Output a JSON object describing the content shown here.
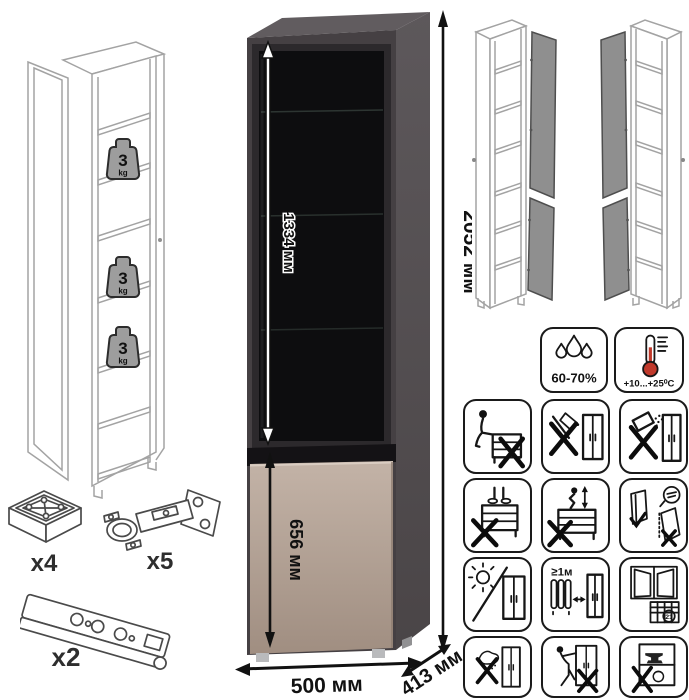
{
  "dimensions": {
    "inner_height": "1334 мм",
    "total_height": "2052 мм",
    "lower_door_height": "656 мм",
    "width": "500 мм",
    "depth": "413 мм"
  },
  "shelf_load": {
    "value": "3",
    "unit": "kg"
  },
  "hardware": {
    "foot_qty": "x4",
    "hinge_qty": "x5",
    "plinth_rail_qty": "x2"
  },
  "care": {
    "humidity": "60-70%",
    "temperature": "+10...+25⁰C",
    "min_heat_distance": "≥1м",
    "calendar_day": "21"
  },
  "icon_names": {
    "climate": [
      "humidity-icon",
      "temperature-icon"
    ],
    "warnings": [
      "do-not-sit-on-furniture",
      "do-not-use-sharp-tools",
      "do-not-spill-on-furniture",
      "do-not-stand-on-furniture",
      "do-not-climb-on-furniture",
      "anchor-to-wall",
      "avoid-direct-sunlight",
      "keep-distance-from-heat",
      "ventilate-room-calendar",
      "do-not-use-wet-cloth",
      "do-not-drag-furniture",
      "do-not-overload"
    ]
  },
  "colors": {
    "carcass_front": "#454043",
    "side_panel_top": "#5d585b",
    "side_panel_bottom": "#4a4547",
    "glass": "#0d0d0f",
    "lower_door_light": "#c3b3a7",
    "lower_door_dark": "#a08e81",
    "open_door_gray": "#8f8f8f",
    "thermometer_red": "#c0392b"
  }
}
